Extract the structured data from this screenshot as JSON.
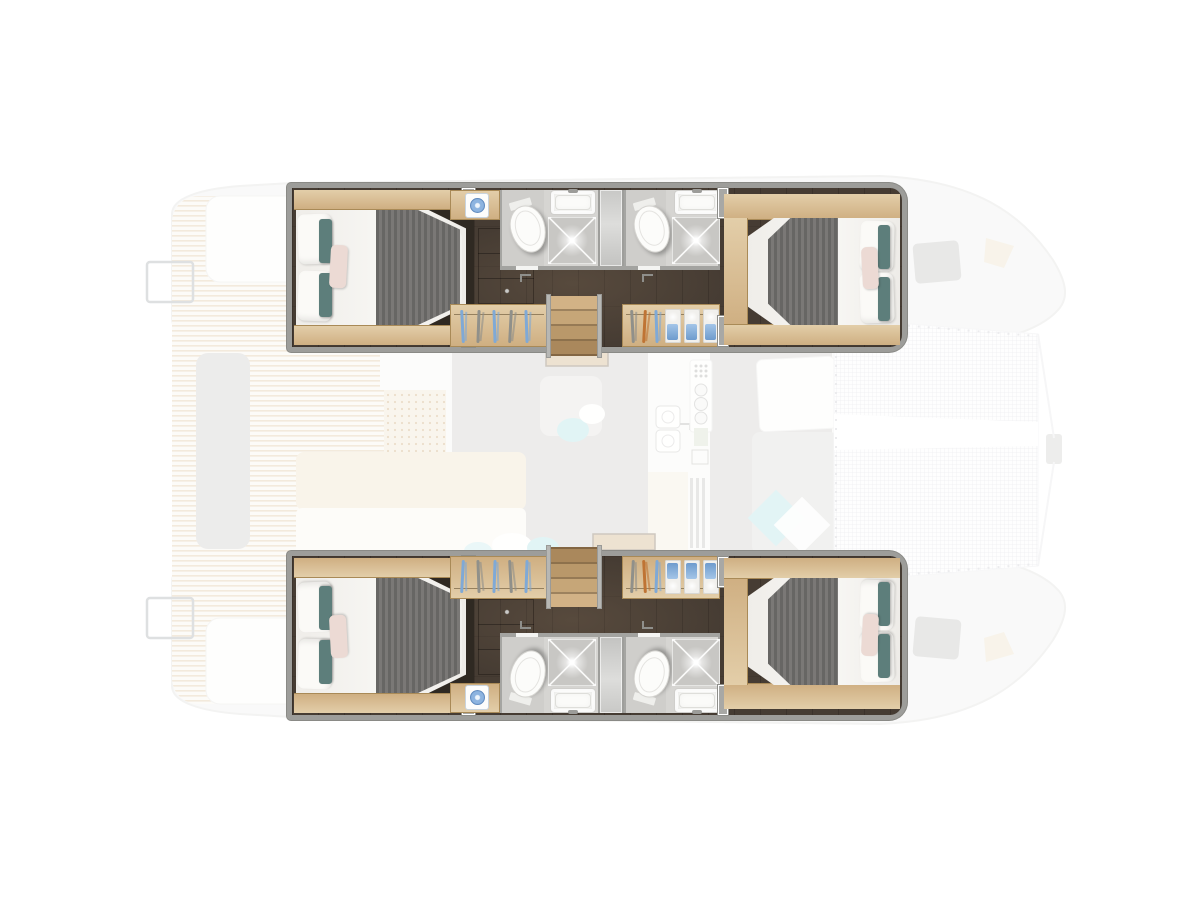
{
  "document": {
    "title": "Catamaran deck and accommodation layout plan",
    "view": "top-down floor plan",
    "orientation": "bow to the right, stern to the left",
    "highlight": "hull accommodation decks shown at full opacity over a faded deck plan"
  },
  "theme": {
    "floor": "#463c33",
    "wood": "#d5bd96",
    "wood-edge": "#a98a57",
    "wall": "#a3a3a0",
    "bath": "#d6d5d2",
    "shower": "#c8c7c4",
    "blanket": "#6c6b69",
    "teal": "#5d7e7b",
    "pink": "#ecdad4",
    "blue": "#7fa9d6",
    "orange": "#bf7434",
    "accent": "#a8dde1",
    "salon-floor": "#c7c6c3",
    "deck-stripe": "#c9ab7e"
  },
  "boat": {
    "hulls": [
      {
        "id": "port",
        "label": "Port hull — aft double cabin, 2 shower rooms with WC, forward double cabin"
      },
      {
        "id": "starboard",
        "label": "Starboard hull — aft double cabin, 2 shower rooms with WC, forward double cabin"
      }
    ],
    "areas": {
      "aft_cockpit": "Aft cockpit with teak deck and bench seating",
      "saloon": "Saloon, dinette and galley",
      "galley": "Galley with double sink and stove",
      "nav": "Chart table",
      "lounge": "Forward cockpit lounge",
      "trampoline": "Foredeck trampoline",
      "helm_seat": "Cockpit seat",
      "swim_ladder": "Transom ladder",
      "bow_hatch": "Deck hatch",
      "aft_cabin": "Aft double cabin",
      "fwd_cabin": "Forward double cabin",
      "berth": "Double berth",
      "bathroom": "Shower room with WC",
      "toilet": "WC",
      "sink": "Washbasin",
      "shower": "Shower",
      "shower_door": "Sliding shower-room door",
      "corridor": "Companionway corridor",
      "dresser": "Chest of drawers",
      "washer": "Washing machine",
      "wardrobe": "Hanging wardrobe",
      "stairs": "Steps down from saloon",
      "closet": "Shelved locker with linens"
    }
  }
}
